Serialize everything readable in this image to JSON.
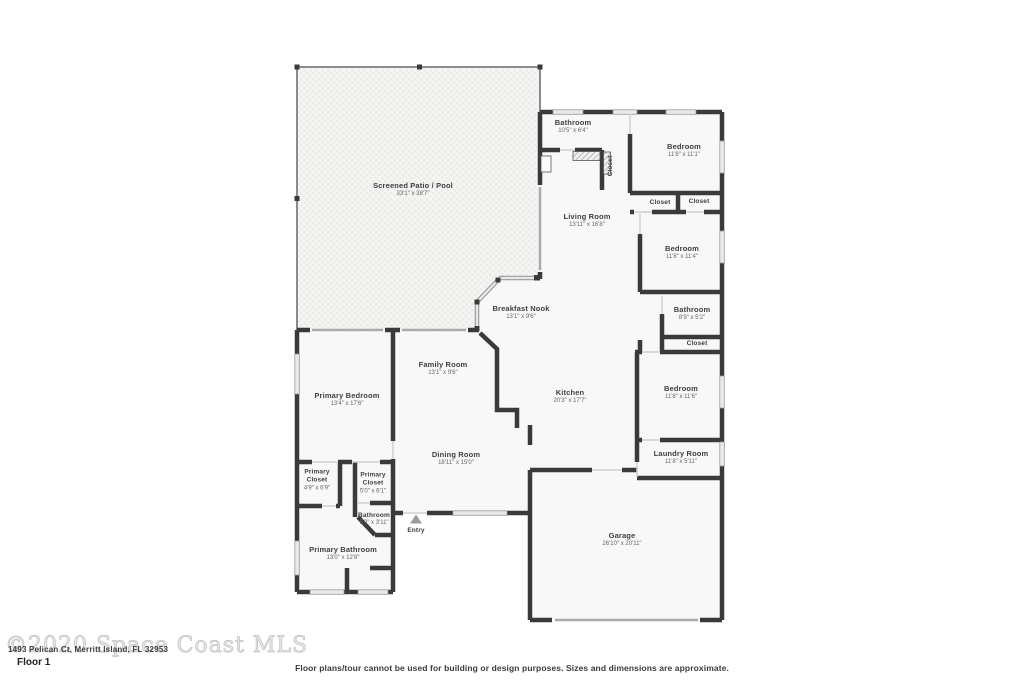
{
  "page": {
    "floor_label": "Floor 1",
    "watermark_text": "©2020 Space Coast MLS",
    "address_text": "1493 Pelican Ct, Merritt Island, FL 32953",
    "disclaimer": "Floor plans/tour cannot be used for building or design purposes. Sizes and dimensions are approximate."
  },
  "colors": {
    "wall": "#3a3a3a",
    "room_fill": "#f8f8f8",
    "patio_fill": "#f5f5f3",
    "window_fill": "#e9e9e9",
    "window_stroke": "#9a9a9a",
    "entry_arrow": "#9c9c9c"
  },
  "rooms": [
    {
      "name": "Screened Patio / Pool",
      "dims": "33'1\" x 38'7\""
    },
    {
      "name": "Bathroom",
      "dims": "10'5\" x 6'4\""
    },
    {
      "name": "Bedroom",
      "dims": "11'8\" x 11'1\""
    },
    {
      "name": "Closet",
      "dims": ""
    },
    {
      "name": "Closet",
      "dims": ""
    },
    {
      "name": "Closet",
      "dims": ""
    },
    {
      "name": "Living Room",
      "dims": "13'11\" x 16'8\""
    },
    {
      "name": "Bedroom",
      "dims": "11'8\" x 11'4\""
    },
    {
      "name": "Bathroom",
      "dims": "8'9\" x 5'2\""
    },
    {
      "name": "Closet",
      "dims": ""
    },
    {
      "name": "Breakfast Nook",
      "dims": "13'1\" x 9'6\""
    },
    {
      "name": "Family Room",
      "dims": "13'1\" x 9'6\""
    },
    {
      "name": "Kitchen",
      "dims": "20'3\" x 17'7\""
    },
    {
      "name": "Bedroom",
      "dims": "11'8\" x 11'6\""
    },
    {
      "name": "Primary Bedroom",
      "dims": "13'4\" x 17'6\""
    },
    {
      "name": "Dining Room",
      "dims": "18'11\" x 15'0\""
    },
    {
      "name": "Laundry Room",
      "dims": "11'8\" x 5'11\""
    },
    {
      "name": "Primary Closet",
      "dims": "4'9\" x 6'9\""
    },
    {
      "name": "Primary Closet",
      "dims": "5'0\" x 6'1\""
    },
    {
      "name": "Bathroom",
      "dims": "5'0\" x 3'11\""
    },
    {
      "name": "Entry",
      "dims": ""
    },
    {
      "name": "Primary Bathroom",
      "dims": "13'0\" x 12'8\""
    },
    {
      "name": "Garage",
      "dims": "26'10\" x 20'11\""
    }
  ]
}
